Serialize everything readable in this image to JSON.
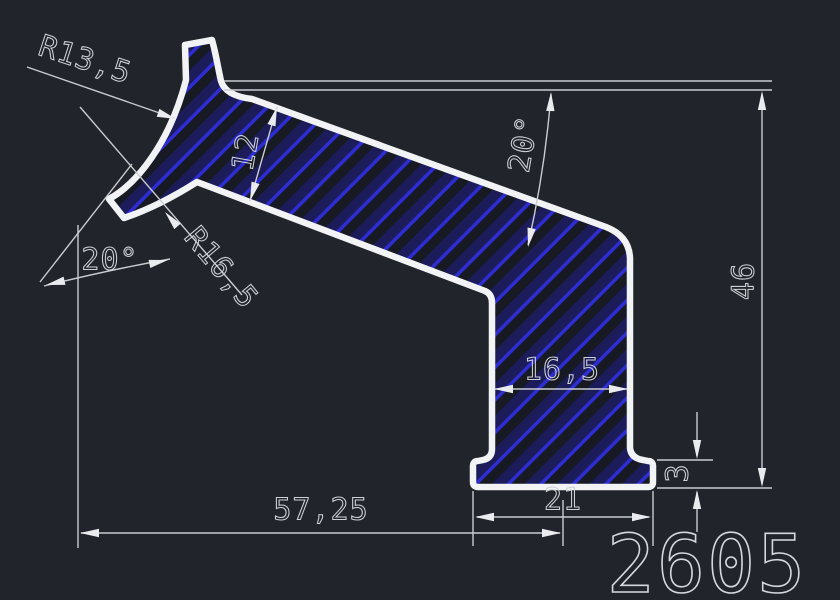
{
  "drawing": {
    "type": "cad-profile-section",
    "part_number": "2605"
  },
  "labels": {
    "radius_top_left": "R13,5",
    "arm_thickness": "12",
    "angle_top": "20°",
    "angle_bottom_left": "20°",
    "radius_bottom_left": "R16,5",
    "overall_height": "46",
    "leg_width": "16,5",
    "flange_thickness": "3",
    "flange_width": "21",
    "overall_length": "57,25",
    "part_number": "2605"
  },
  "colors": {
    "background": "#21242a",
    "profile_outline": "#f1f3f5",
    "dimension_lines": "#c9ccd1",
    "dimension_text": "#ced2d6",
    "hatch_bright_blue": "#2d2dd2",
    "hatch_dark_blue": "#1c1c5a",
    "section_fill": "#171923"
  }
}
